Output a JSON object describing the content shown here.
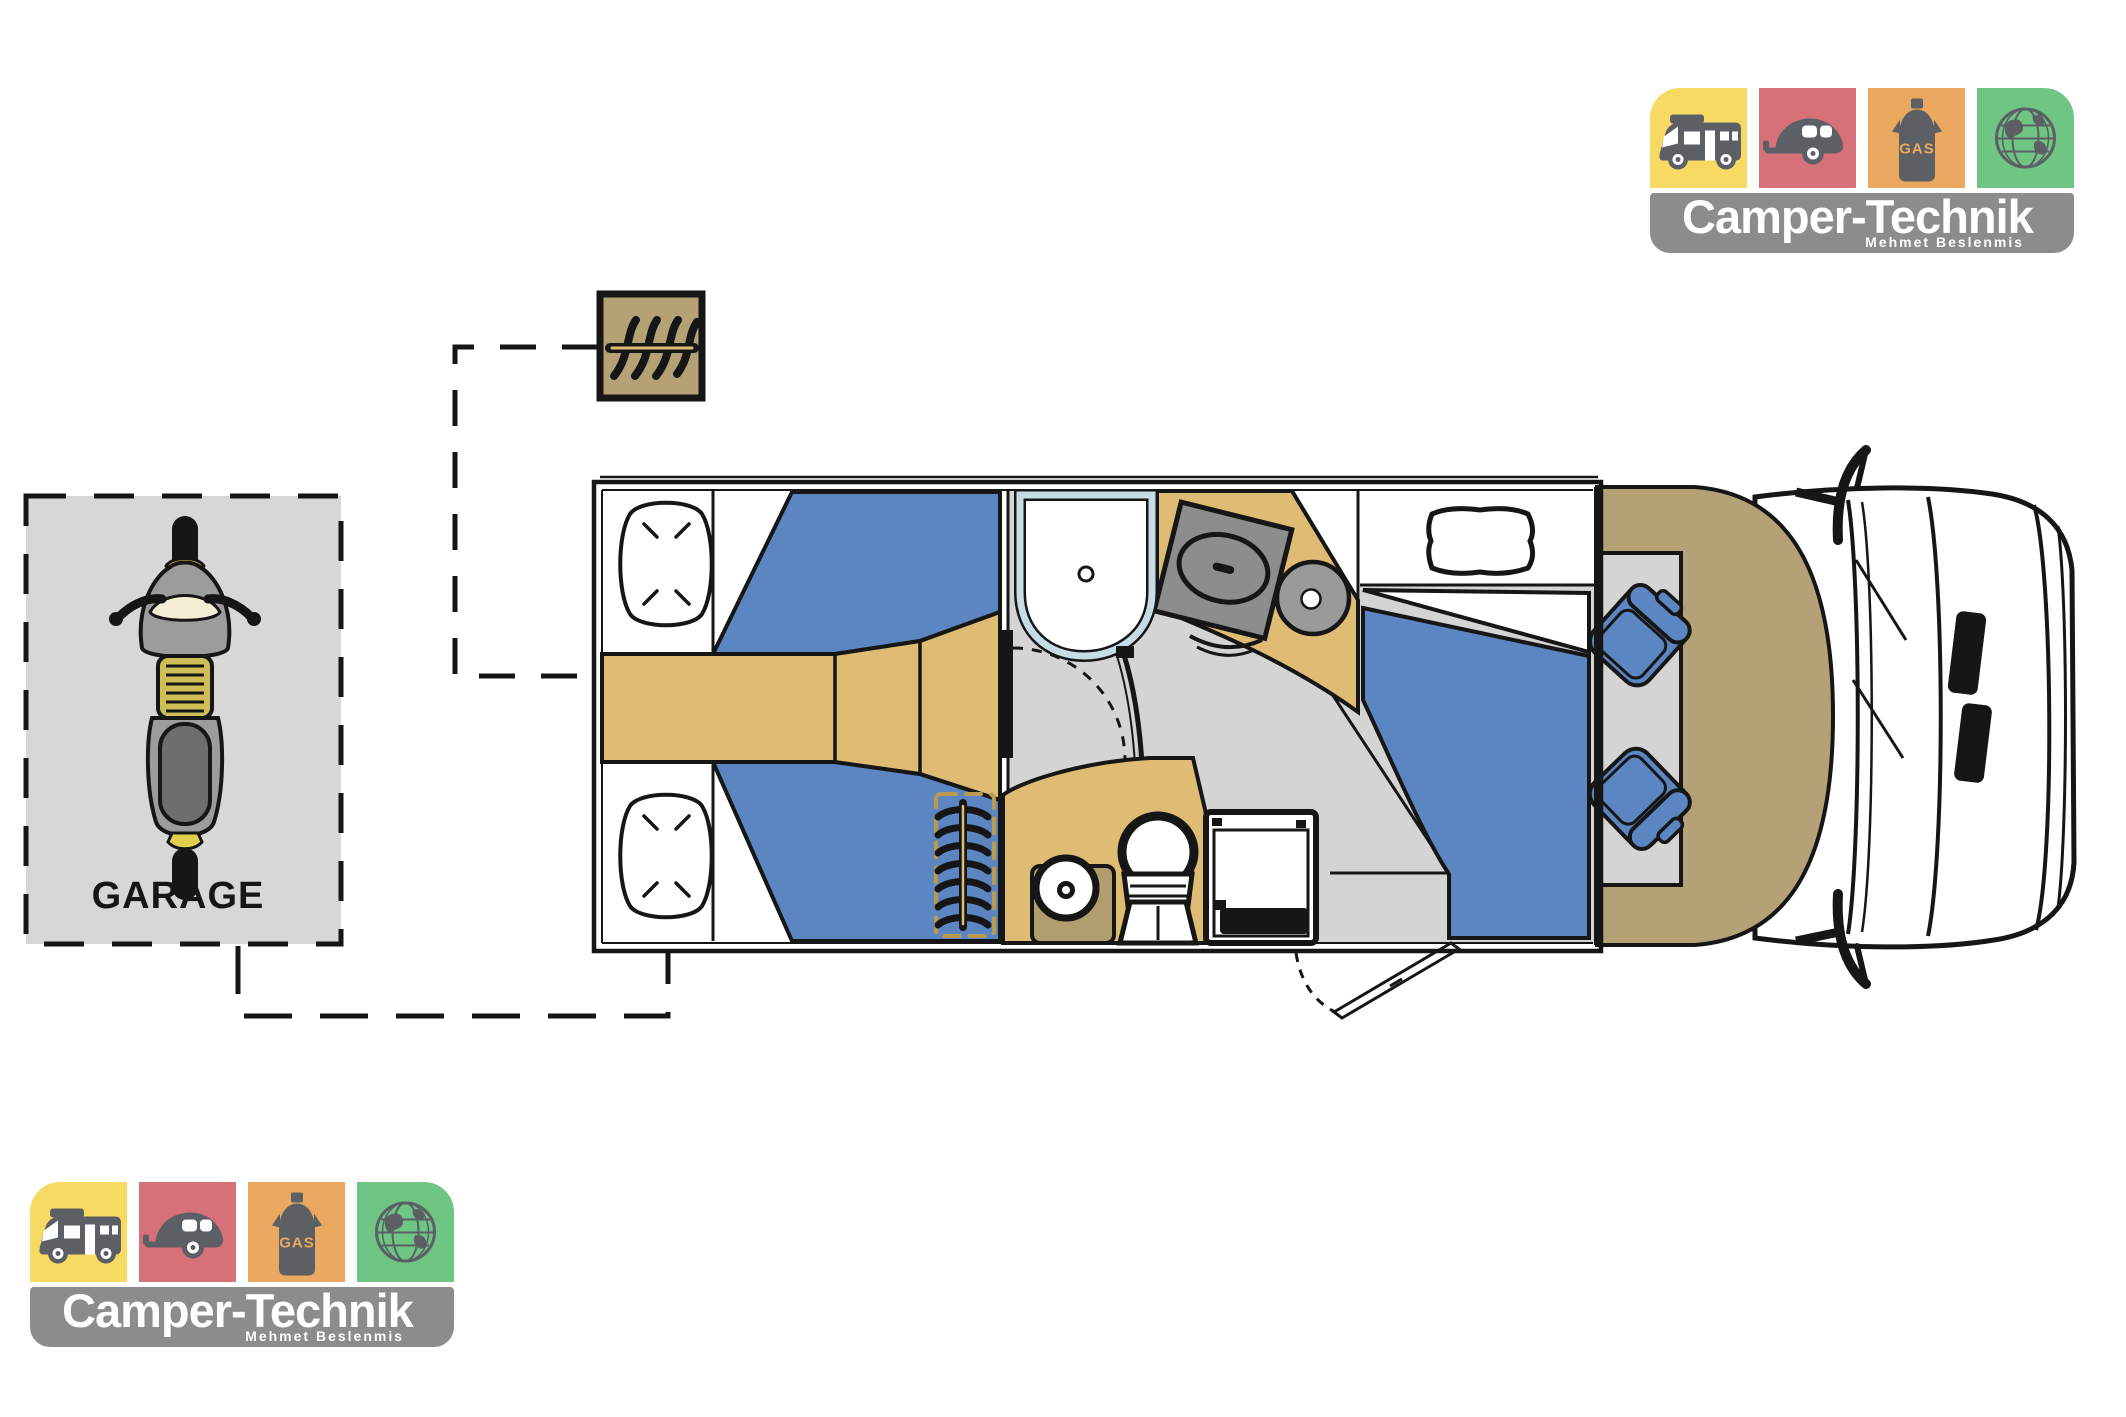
{
  "logo": {
    "title": "Camper-Technik",
    "subtitle": "Mehmet Beslenmis",
    "tiles": [
      {
        "icon": "motorhome-icon",
        "color_key": "yellow"
      },
      {
        "icon": "caravan-icon",
        "color_key": "red"
      },
      {
        "icon": "gas-bottle-icon",
        "color_key": "orange",
        "label": "GAS"
      },
      {
        "icon": "globe-icon",
        "color_key": "green"
      }
    ]
  },
  "garage": {
    "label": "GARAGE",
    "icon": "scooter-icon"
  },
  "floorplan": {
    "areas": [
      "rear-twin-beds",
      "bed-pillows",
      "center-aisle-wardrobe",
      "shower-cabin",
      "kitchen-stove",
      "kitchen-sink",
      "bathroom-door",
      "washbasin",
      "toilet",
      "fridge",
      "dinette-table",
      "dinette-seating",
      "cab-lounge",
      "swivel-cab-seats",
      "entry-door",
      "vehicle-cab",
      "interior-ladder",
      "roof-ladder-box"
    ],
    "icons": [
      "rear-ladder-icon",
      "interior-ladder-icon",
      "scooter-icon"
    ]
  },
  "colors": {
    "yellow": "#f6da64",
    "red": "#d6717a",
    "orange": "#eaa860",
    "green": "#6ec584",
    "banner_gray": "#8c8c8c",
    "icon_gray": "#5c5f63",
    "blue": "#5c86c2",
    "tan": "#dfbc74",
    "khaki": "#b5a176",
    "floor_gray": "#d4d4d4",
    "stove_gray": "#8d8d8d",
    "sink_gray": "#9a9a9a",
    "shower_border": "#c7dde5",
    "basin_pad": "#b19d6e",
    "pad_dash": "#ba9a4f",
    "garage_gray": "#d7d7d7",
    "scooter_gray": "#9c9c9c",
    "seat_dark": "#6e6e6e",
    "accent_yellow": "#e3cf4e",
    "line": "#161616"
  }
}
